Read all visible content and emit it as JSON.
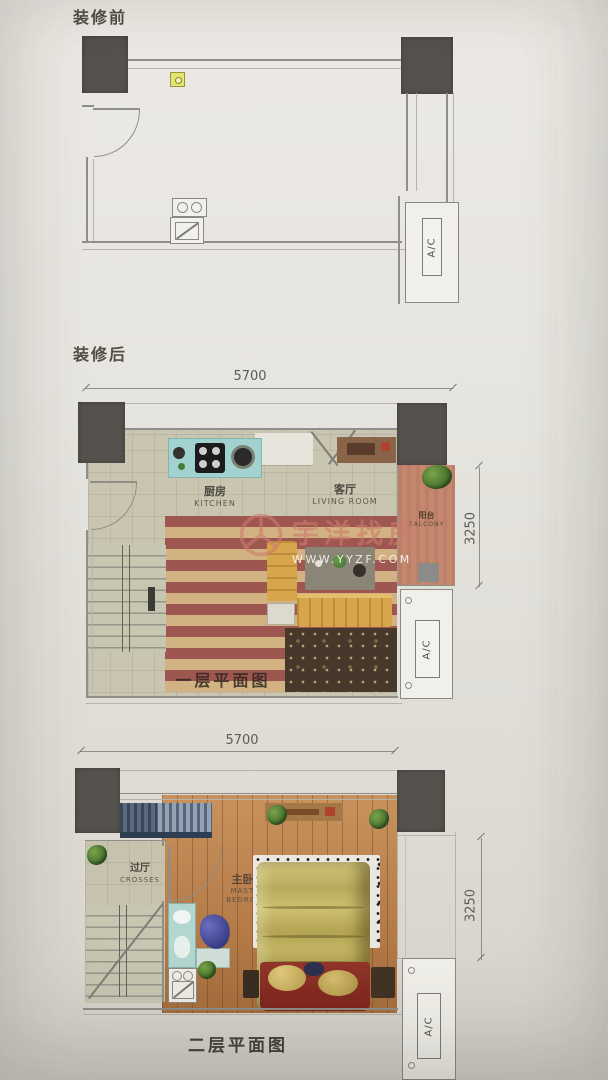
{
  "sections": {
    "before": {
      "title": "装修前"
    },
    "after": {
      "title": "装修后"
    }
  },
  "plan_before": {
    "ac_label": "A/C"
  },
  "plan_floor1": {
    "dim_width": "5700",
    "dim_depth": "3250",
    "kitchen_zh": "厨房",
    "kitchen_en": "KITCHEN",
    "living_zh": "客厅",
    "living_en": "LIVING ROOM",
    "balcony_zh": "阳台",
    "balcony_en": "BALCONY",
    "ac_label": "A/C",
    "caption": "一层平面图"
  },
  "plan_floor2": {
    "dim_width": "5700",
    "dim_depth": "3250",
    "hall_zh": "过厅",
    "hall_en": "CROSSES",
    "master_zh": "主卧室",
    "master_en1": "MASTER",
    "master_en2": "BEDROOM",
    "ac_label": "A/C",
    "caption": "二层平面图"
  },
  "watermark": {
    "brand": "宇洋找房",
    "url": "WWW.YYZF.COM"
  },
  "colors": {
    "paper": "#e7e5df",
    "wall_line": "#8f8f89",
    "column": "#55524d",
    "rug_red": "#9e5650",
    "rug_tan": "#d2b183",
    "sofa_yellow": "#d7a64c",
    "kitchen_counter_teal": "#a2d2d0",
    "balcony_terracotta": "#c6876f",
    "wood_floor": "#ba7c46",
    "bed_olive": "#c3b464",
    "blanket_red": "#8e3028",
    "watermark_pink": "#cb7b6c",
    "outlet_yellow": "#e4e470"
  }
}
